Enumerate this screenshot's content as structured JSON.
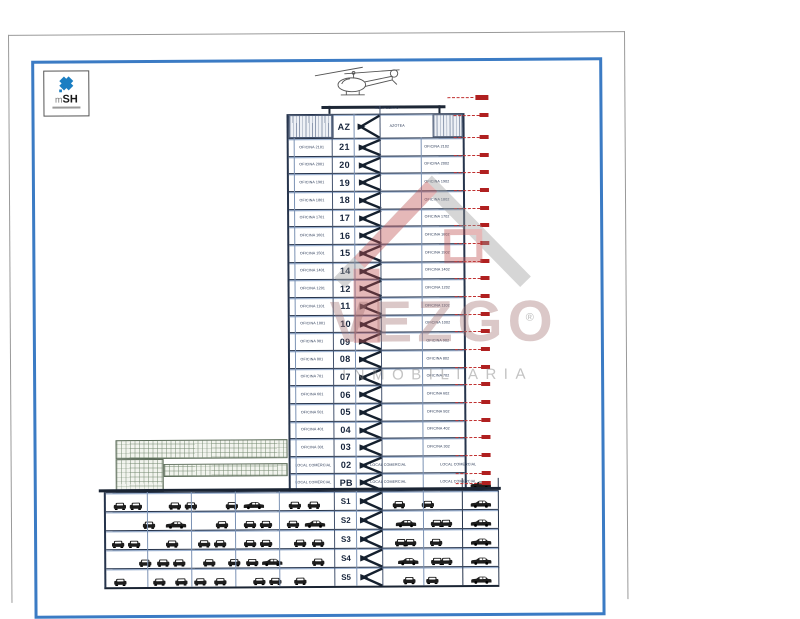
{
  "page": {
    "frame_color": "#3b7bc4"
  },
  "logo": {
    "prefix": "m",
    "name": "SH",
    "icon_color": "#1b7ec2"
  },
  "heliport": {
    "label": "HELIPUERTO"
  },
  "roof": {
    "number": "AZ",
    "label": "AZOTEA"
  },
  "floors": [
    {
      "num": "21",
      "left": "OFICINA 2101",
      "right": "OFICINA 2102"
    },
    {
      "num": "20",
      "left": "OFICINA 2001",
      "right": "OFICINA 2002"
    },
    {
      "num": "19",
      "left": "OFICINA 1901",
      "right": "OFICINA 1902"
    },
    {
      "num": "18",
      "left": "OFICINA 1801",
      "right": "OFICINA 1802"
    },
    {
      "num": "17",
      "left": "OFICINA 1701",
      "right": "OFICINA 1702"
    },
    {
      "num": "16",
      "left": "OFICINA 1601",
      "right": "OFICINA 1602"
    },
    {
      "num": "15",
      "left": "OFICINA 1501",
      "right": "OFICINA 1502"
    },
    {
      "num": "14",
      "left": "OFICINA 1401",
      "right": "OFICINA 1402"
    },
    {
      "num": "12",
      "left": "OFICINA 1201",
      "right": "OFICINA 1202"
    },
    {
      "num": "11",
      "left": "OFICINA 1101",
      "right": "OFICINA 1102"
    },
    {
      "num": "10",
      "left": "OFICINA 1001",
      "right": "OFICINA 1002"
    },
    {
      "num": "09",
      "left": "OFICINA 901",
      "right": "OFICINA 902"
    },
    {
      "num": "08",
      "left": "OFICINA 801",
      "right": "OFICINA 802"
    },
    {
      "num": "07",
      "left": "OFICINA 701",
      "right": "OFICINA 702"
    },
    {
      "num": "06",
      "left": "OFICINA 601",
      "right": "OFICINA 602"
    },
    {
      "num": "05",
      "left": "OFICINA 501",
      "right": "OFICINA 502"
    },
    {
      "num": "04",
      "left": "OFICINA 401",
      "right": "OFICINA 402"
    },
    {
      "num": "03",
      "left": "OFICINA 301",
      "right": "OFICINA 302"
    },
    {
      "num": "02",
      "left": "LOCAL COMERCIAL",
      "right": "LOCAL COMERCIAL",
      "right2": "LOCAL COMERCIAL"
    },
    {
      "num": "PB",
      "left": "LOCAL COMERCIAL",
      "right": "LOCAL COMERCIAL",
      "right2": "LOCAL COMERCIAL"
    }
  ],
  "basements": [
    {
      "num": "S1",
      "left_cars": [
        [
          "f",
          0.03
        ],
        [
          "f",
          0.1
        ],
        [
          "f",
          0.27
        ],
        [
          "f",
          0.34
        ],
        [
          "f",
          0.52
        ],
        [
          "s",
          0.6
        ],
        [
          "f",
          0.8
        ],
        [
          "f",
          0.88
        ]
      ],
      "right_cars": [
        [
          "f",
          0.12
        ],
        [
          "f",
          0.5
        ]
      ]
    },
    {
      "num": "S2",
      "left_cars": [
        [
          "f",
          0.16
        ],
        [
          "s",
          0.26
        ],
        [
          "f",
          0.48
        ],
        [
          "f",
          0.6
        ],
        [
          "f",
          0.67
        ],
        [
          "f",
          0.79
        ],
        [
          "s",
          0.87
        ]
      ],
      "right_cars": [
        [
          "s",
          0.16
        ],
        [
          "f",
          0.62
        ],
        [
          "f",
          0.74
        ]
      ]
    },
    {
      "num": "S3",
      "left_cars": [
        [
          "f",
          0.02
        ],
        [
          "f",
          0.09
        ],
        [
          "f",
          0.26
        ],
        [
          "f",
          0.4
        ],
        [
          "f",
          0.47
        ],
        [
          "f",
          0.6
        ],
        [
          "f",
          0.67
        ],
        [
          "f",
          0.82
        ],
        [
          "f",
          0.9
        ]
      ],
      "right_cars": [
        [
          "f",
          0.15
        ],
        [
          "f",
          0.26
        ],
        [
          "f",
          0.6
        ]
      ]
    },
    {
      "num": "S4",
      "left_cars": [
        [
          "f",
          0.14
        ],
        [
          "f",
          0.22
        ],
        [
          "f",
          0.29
        ],
        [
          "f",
          0.42
        ],
        [
          "f",
          0.53
        ],
        [
          "f",
          0.61
        ],
        [
          "s",
          0.68
        ],
        [
          "f",
          0.9
        ]
      ],
      "right_cars": [
        [
          "s",
          0.18
        ],
        [
          "f",
          0.62
        ],
        [
          "f",
          0.74
        ]
      ]
    },
    {
      "num": "S5",
      "left_cars": [
        [
          "f",
          0.03
        ],
        [
          "f",
          0.2
        ],
        [
          "f",
          0.3
        ],
        [
          "f",
          0.38
        ],
        [
          "f",
          0.47
        ],
        [
          "f",
          0.64
        ],
        [
          "f",
          0.71
        ],
        [
          "f",
          0.82
        ]
      ],
      "right_cars": [
        [
          "f",
          0.25
        ],
        [
          "f",
          0.55
        ]
      ]
    }
  ],
  "ramp_levels": 6,
  "watermark": {
    "brand": "VEZGO",
    "subtitle": "INMOBILIARIA",
    "registered": "®"
  },
  "colors": {
    "line_dark": "#26344c",
    "line_light": "#7b92b4",
    "red": "#b02020",
    "car": "#1d1d1d"
  }
}
